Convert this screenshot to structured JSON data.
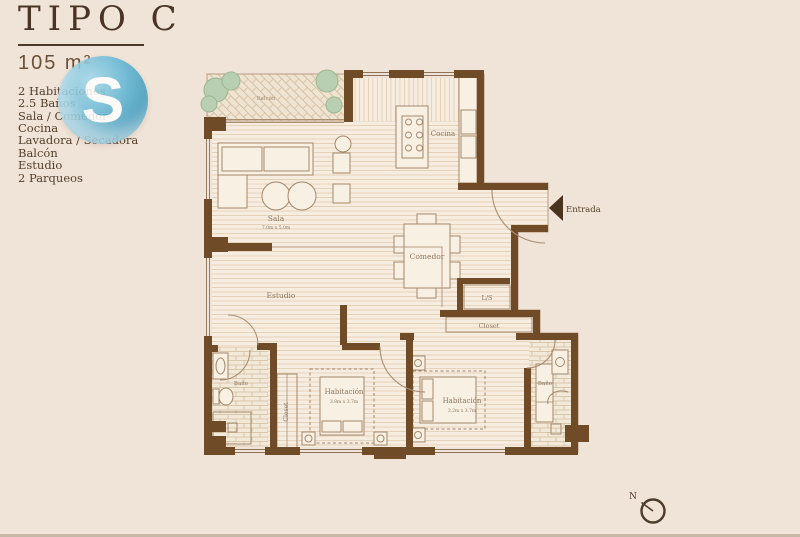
{
  "panel": {
    "title": "TIPO C",
    "area": "105 m²",
    "features": [
      "2 Habitaciones",
      "2.5 Baños",
      "Sala / Comedor",
      "Cocina",
      "Lavadora / Secadora",
      "Balcón",
      "Estudio",
      "2 Parqueos"
    ],
    "logo_letter": "S"
  },
  "plan": {
    "labels": {
      "balcony": "Balcón",
      "kitchen": "Cocina",
      "entrance": "Entrada",
      "living": "Sala",
      "living_dims": "7.0m x 5.0m",
      "dining": "Comedor",
      "study": "Estudio",
      "laundry": "L/S",
      "closet": "Closet",
      "closet_vertical": "Closet",
      "bath_left": "Baño",
      "bath_right": "Baño",
      "bedroom1": "Habitación",
      "bedroom1_dims": "3.8m x 3.7m",
      "bedroom2": "Habitación",
      "bedroom2_dims": "3.2m x 3.7m"
    },
    "compass": {
      "label": "N"
    }
  },
  "colors": {
    "background": "#f0e3d7",
    "wall": "#6f4b28",
    "logo_blue": "#55b0d2",
    "tree_green": "#b9cfb2"
  }
}
